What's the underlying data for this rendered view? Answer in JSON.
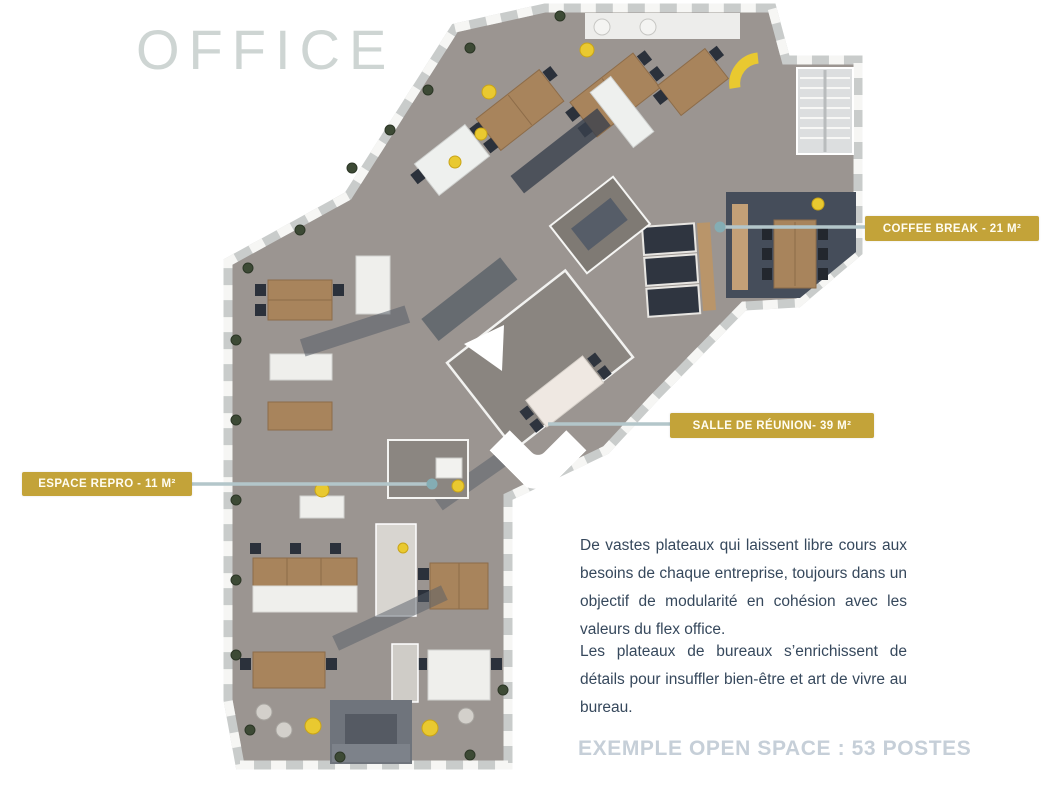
{
  "page": {
    "title": "OFFICE",
    "caption": "EXEMPLE OPEN SPACE : 53 POSTES"
  },
  "annotations": {
    "coffee_break": {
      "label": "COFFEE BREAK - 21 M²",
      "area_m2": 21
    },
    "meeting_room": {
      "label": "SALLE DE RÉUNION- 39 M²",
      "area_m2": 39
    },
    "repro": {
      "label": "ESPACE REPRO - 11 M²",
      "area_m2": 11
    }
  },
  "paragraphs": {
    "p1": "De vastes plateaux qui laissent libre cours aux besoins de chaque entreprise, toujours dans un objectif de modularité en cohésion avec les valeurs du flex office.",
    "p2": "Les plateaux de bureaux s’enrichissent de détails pour insuffler bien-être et art de vivre au bureau."
  },
  "colors": {
    "accent_gold": "#c3a339",
    "title_gray": "#ced5d3",
    "caption_gray": "#c6cfd8",
    "body_text": "#36485c",
    "connector_line": "#b3c6ca",
    "floor_gray": "#9b9591",
    "wood": "#a8845c",
    "dark_furniture": "#39414d",
    "pouf_yellow": "#e9c930"
  }
}
